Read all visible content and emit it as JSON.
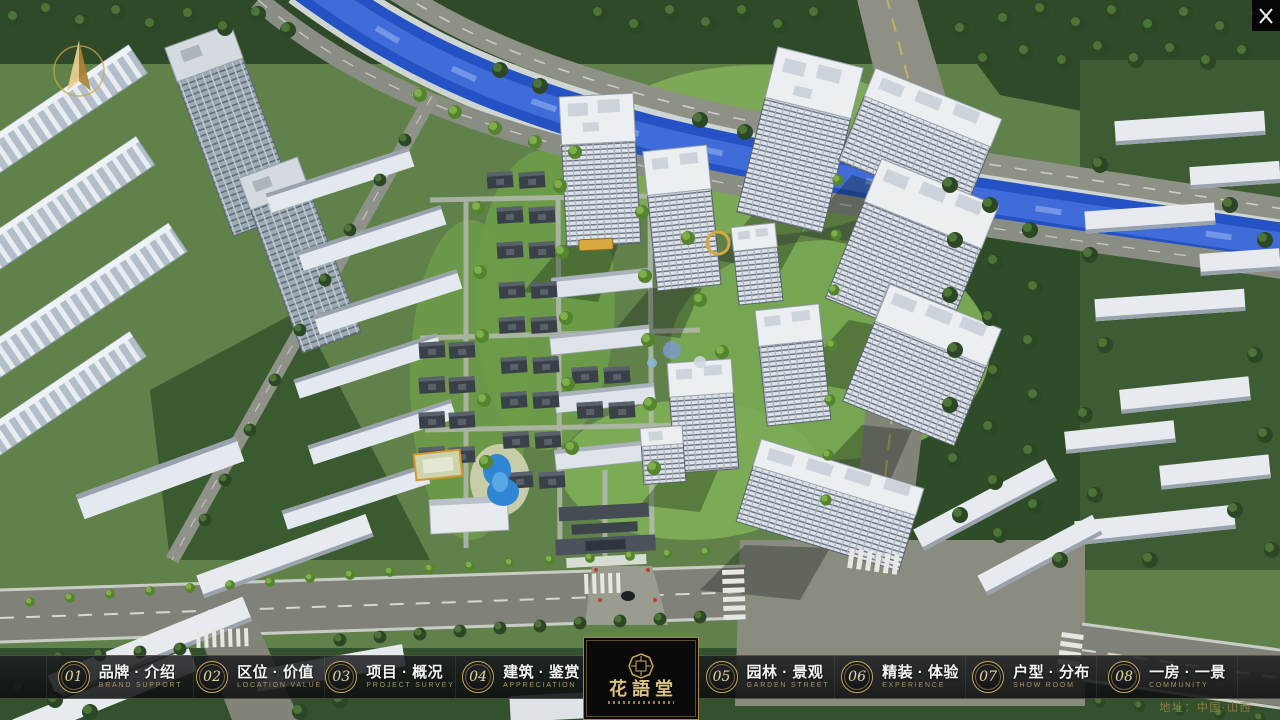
{
  "app": {
    "title": "花語堂"
  },
  "nav": {
    "items": [
      {
        "num": "01",
        "label": "品牌 · 介绍",
        "sublabel": "BRAND SUPPORT"
      },
      {
        "num": "02",
        "label": "区位 · 价值",
        "sublabel": "LOCATION VALUE"
      },
      {
        "num": "03",
        "label": "项目 · 概况",
        "sublabel": "PROJECT SURVEY"
      },
      {
        "num": "04",
        "label": "建筑 · 鉴赏",
        "sublabel": "APPRECIATION"
      },
      {
        "num": "05",
        "label": "园林 · 景观",
        "sublabel": "GARDEN STREET"
      },
      {
        "num": "06",
        "label": "精装 · 体验",
        "sublabel": "EXPERIENCE"
      },
      {
        "num": "07",
        "label": "户型 · 分布",
        "sublabel": "SHOW ROOM"
      },
      {
        "num": "08",
        "label": "一房 · 一景",
        "sublabel": "COMMUNITY"
      }
    ]
  },
  "logo": {
    "title": "花語堂"
  },
  "footer": {
    "address": "地址：中国·山西"
  },
  "icons": {
    "close": "✕",
    "compass": "north-arrow",
    "seal": "octagonal-seal"
  },
  "colors": {
    "gold": "#c8ab66",
    "gold_dim": "#ad955c",
    "bar_bg": "rgba(14,16,18,0.85)",
    "river": "#2452c4",
    "panel_bg": "#0a0a0b"
  }
}
